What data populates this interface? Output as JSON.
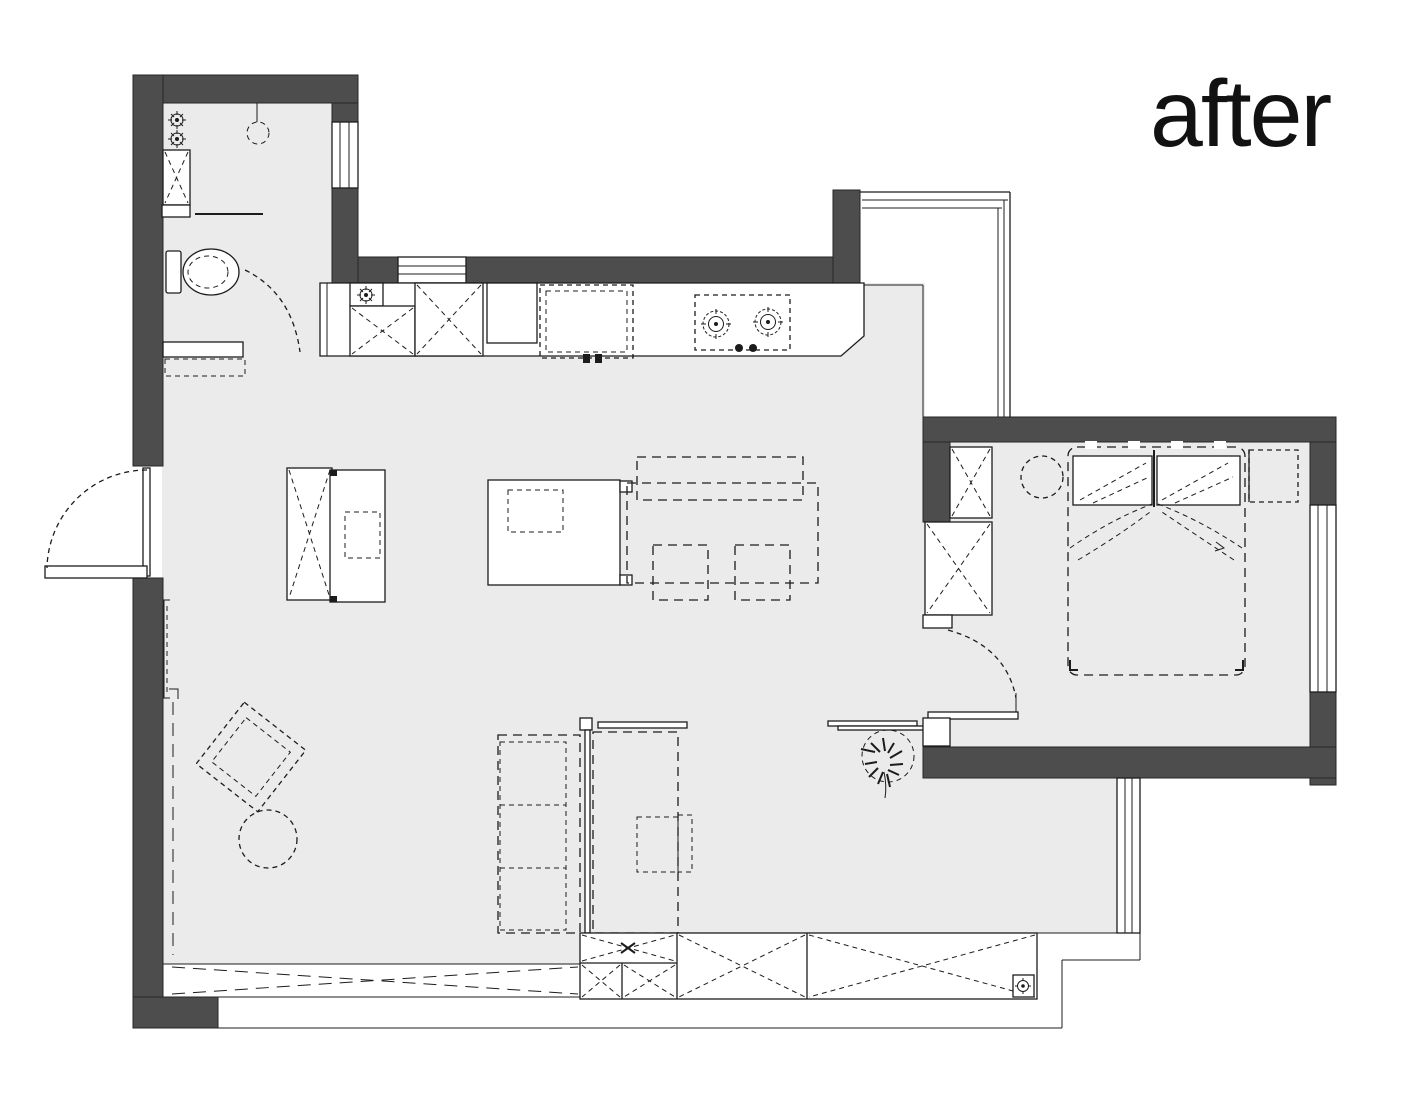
{
  "title": {
    "label": "after"
  },
  "colors": {
    "wall": "#4d4d4d",
    "floor": "#ebebeb",
    "line": "#1c1c1c",
    "background": "#ffffff"
  }
}
